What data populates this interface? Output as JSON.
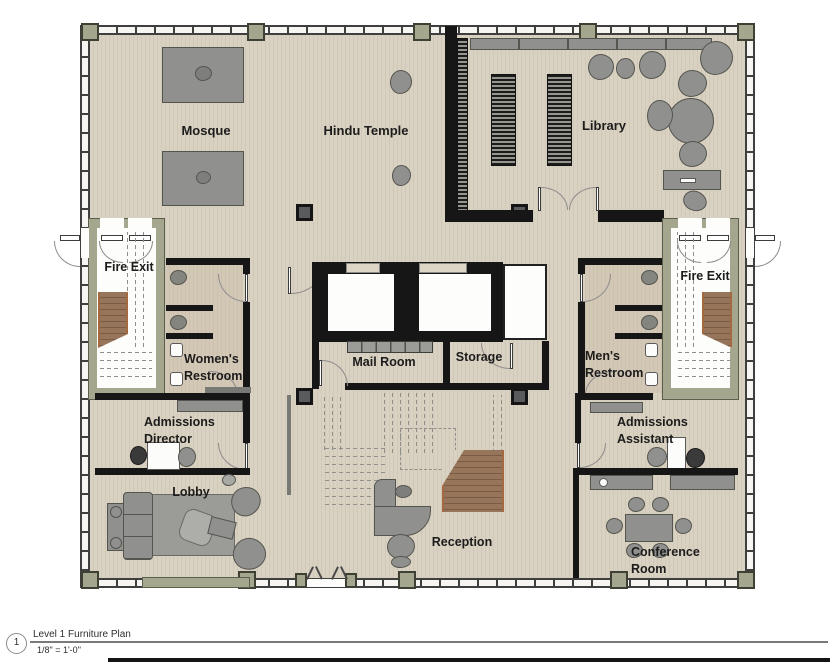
{
  "drawing": {
    "title": "Level 1 Furniture Plan",
    "scale": "1/8\" = 1'-0\"",
    "detail_number": "1"
  },
  "rooms": {
    "mosque": {
      "label": "Mosque"
    },
    "hindu_temple": {
      "label": "Hindu Temple"
    },
    "library": {
      "label": "Library"
    },
    "fire_exit_left": {
      "label": "Fire Exit"
    },
    "fire_exit_right": {
      "label": "Fire Exit"
    },
    "womens_restroom": {
      "label": "Women's\nRestroom"
    },
    "mens_restroom": {
      "label": "Men's\nRestroom"
    },
    "mail_room": {
      "label": "Mail Room"
    },
    "storage": {
      "label": "Storage"
    },
    "admissions_director": {
      "label": "Admissions\nDirector"
    },
    "admissions_assistant": {
      "label": "Admissions\nAssistant"
    },
    "lobby": {
      "label": "Lobby"
    },
    "reception": {
      "label": "Reception"
    },
    "conference_room": {
      "label": "Conference\nRoom"
    }
  },
  "colors": {
    "floor": "#d9d1c1",
    "wall": "#161616",
    "structure_green": "#a4a78d",
    "furniture_gray": "#90918f",
    "stair_wood": "#96755a",
    "label_text": "#1c1c1c"
  }
}
